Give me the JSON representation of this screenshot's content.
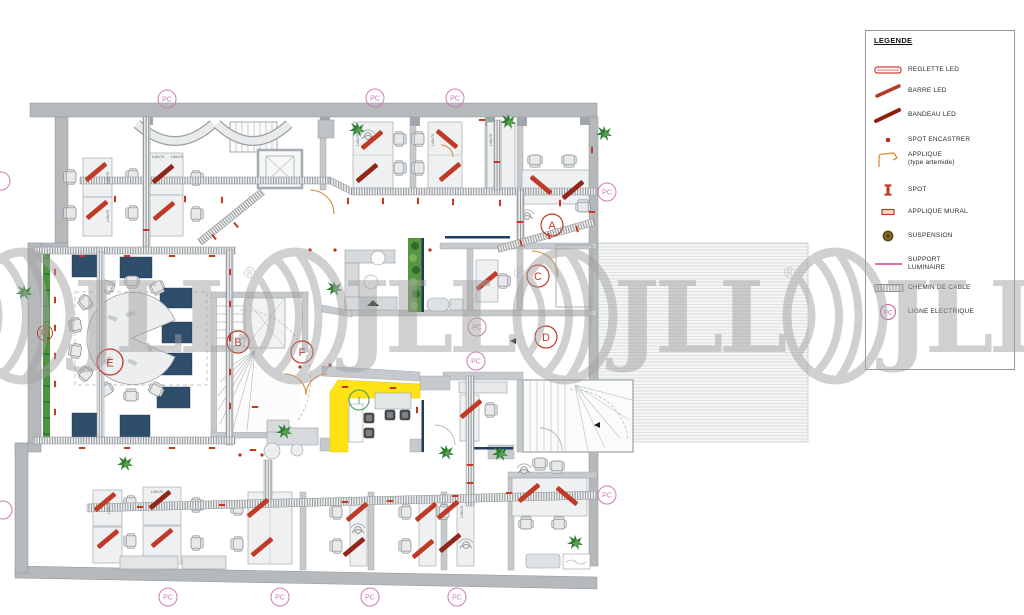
{
  "legend": {
    "title": "LEGENDE",
    "pc_symbol": "PC",
    "items": [
      {
        "icon": "reglette-led-icon",
        "label": "REGLETTE LED"
      },
      {
        "icon": "barre-led-icon",
        "label": "BARRE LED"
      },
      {
        "icon": "bandeau-led-icon",
        "label": "BANDEAU LED"
      },
      {
        "icon": "spot-encastrer-icon",
        "label": "SPOT ENCASTRER"
      },
      {
        "icon": "applique-icon",
        "label": "APPLIQUE",
        "label2": "(type artemide)"
      },
      {
        "icon": "spot-icon",
        "label": "SPOT"
      },
      {
        "icon": "applique-mural-icon",
        "label": "APPLIQUE MURAL"
      },
      {
        "icon": "suspension-icon",
        "label": "SUSPENSION"
      },
      {
        "icon": "support-luminaire-icon",
        "label": "SUPPORT",
        "label2": "LUMINAIRE"
      },
      {
        "icon": "chemin-de-cable-icon",
        "label": "CHEMIN DE CABLE"
      },
      {
        "icon": "ligne-electrique-icon",
        "label": "LIGNE ELECTRIQUE"
      }
    ]
  },
  "plan": {
    "pc": "PC",
    "desk": "140x70",
    "zones": {
      "a": "A",
      "b": "B",
      "c": "C",
      "d": "D",
      "e": "E",
      "f": "F",
      "g": "G",
      "i": "I"
    }
  },
  "watermark": {
    "text": "JLL",
    "reg": "®"
  },
  "colors": {
    "led_red": "#bf3a27",
    "bandeau_red": "#93261a",
    "pc_pink": "#cf7ab2",
    "wall_grey": "#b5b9bc",
    "navy": "#2f4e6b",
    "yellow": "#ffe214",
    "green": "#4c9440",
    "orange": "#d98c35",
    "watermark_grey": "#a2a2a2"
  }
}
